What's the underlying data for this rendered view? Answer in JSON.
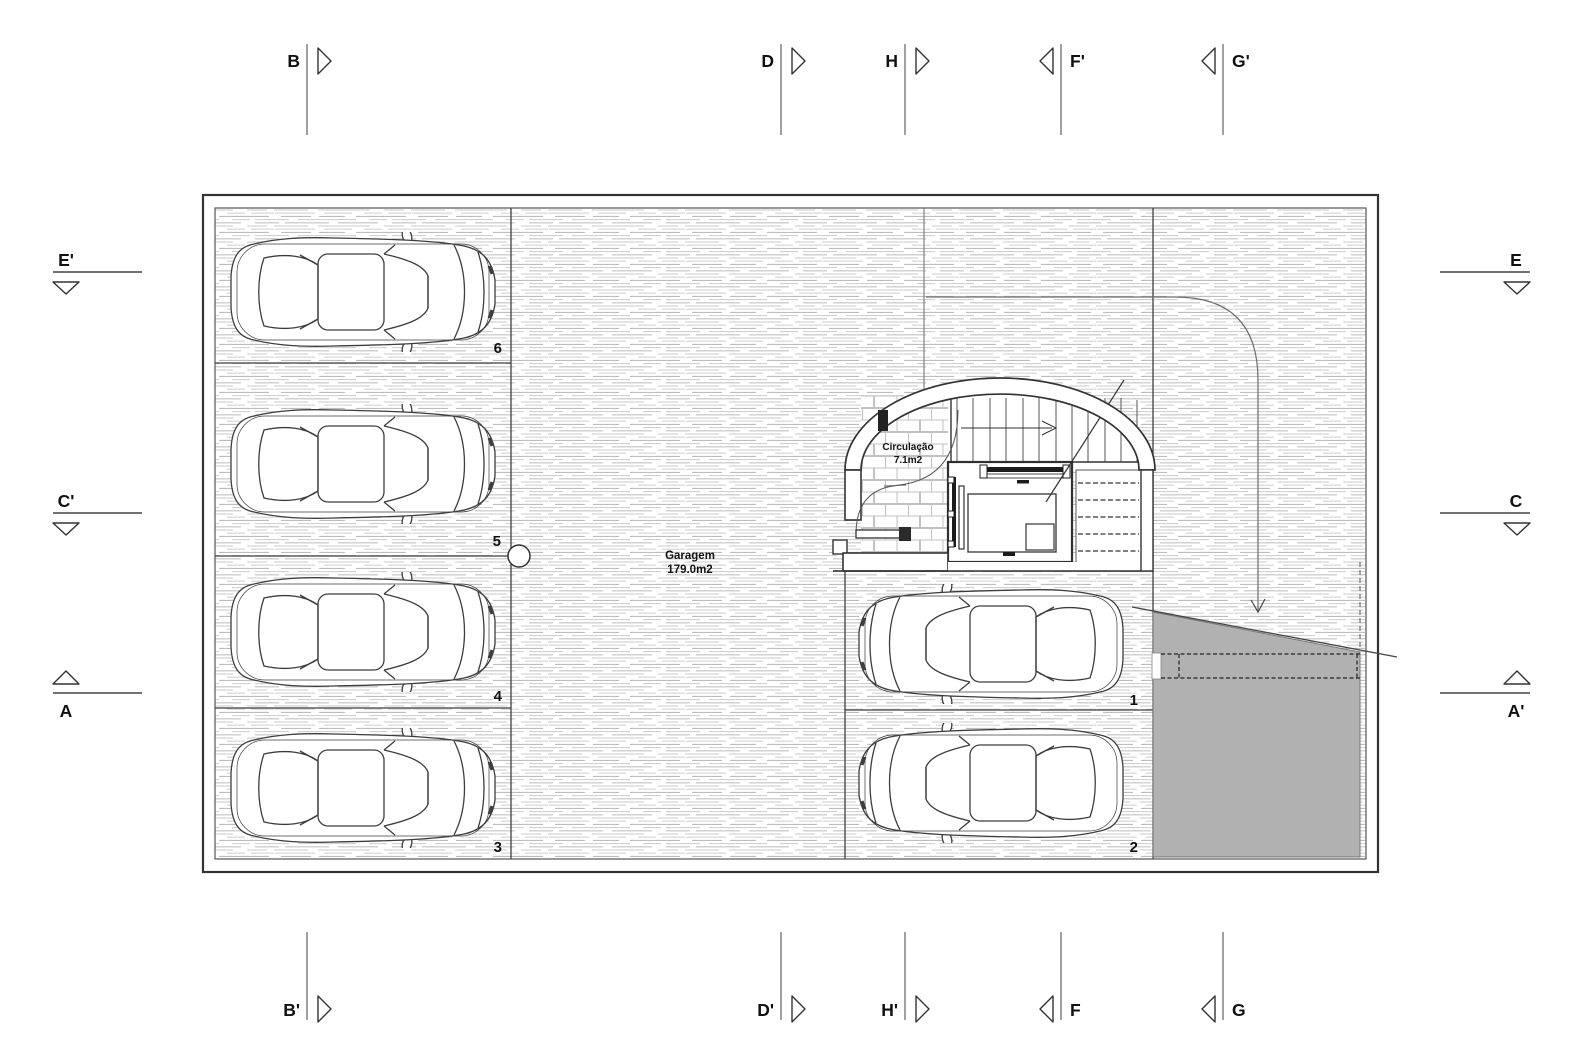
{
  "drawing": {
    "rooms": {
      "garage": {
        "name": "Garagem",
        "area": "179.0m2"
      },
      "circulation": {
        "name": "Circulação",
        "area": "7.1m2"
      }
    },
    "parking": [
      "6",
      "5",
      "4",
      "3",
      "1",
      "2"
    ],
    "markers": {
      "top": [
        {
          "label": "B"
        },
        {
          "label": "D"
        },
        {
          "label": "H"
        },
        {
          "label": "F'"
        },
        {
          "label": "G'"
        }
      ],
      "bottom": [
        {
          "label": "B'"
        },
        {
          "label": "D'"
        },
        {
          "label": "H'"
        },
        {
          "label": "F"
        },
        {
          "label": "G"
        }
      ],
      "left": [
        {
          "label": "E'"
        },
        {
          "label": "C'"
        },
        {
          "label": "A"
        }
      ],
      "right": [
        {
          "label": "E"
        },
        {
          "label": "C"
        },
        {
          "label": "A'"
        }
      ]
    },
    "colors": {
      "line": "#3a3a3a",
      "hatch": "#c6c6c6",
      "ramp_gray": "#b1b1b1"
    }
  }
}
